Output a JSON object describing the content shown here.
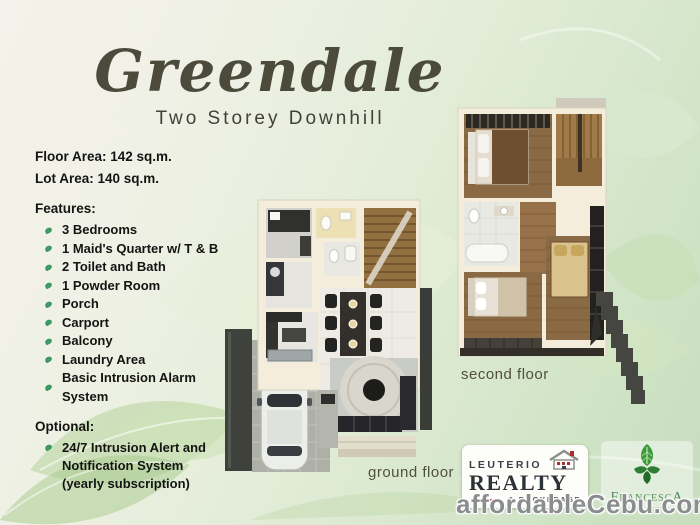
{
  "header": {
    "title": "Greendale",
    "subtitle": "Two Storey Downhill"
  },
  "specs": {
    "floor_area": "Floor Area: 142 sq.m.",
    "lot_area": "Lot Area: 140 sq.m."
  },
  "features": {
    "heading": "Features:",
    "items": [
      "3 Bedrooms",
      "1 Maid's Quarter w/ T & B",
      "2 Toilet and Bath",
      "1 Powder Room",
      "Porch",
      "Carport",
      "Balcony",
      "Laundry Area",
      "Basic Intrusion Alarm System"
    ]
  },
  "optional": {
    "heading": "Optional:",
    "lines": [
      "24/7 Intrusion Alert and",
      "Notification System",
      "(yearly subscription)"
    ]
  },
  "plans": {
    "ground_label": "ground floor",
    "second_label": "second floor"
  },
  "brands": {
    "leuterio": {
      "name_top": "LEUTERIO",
      "name_main": "REALTY",
      "name_sub": "& BROKERAGE"
    },
    "francesca": {
      "name": "FrancescA"
    }
  },
  "watermark": "affordableCebu.com",
  "colors": {
    "accent_green": "#3f9b63",
    "title_olive": "#4c4b3b",
    "floor_label_gray": "#50503f",
    "watermark_gray": "#8b8d8f",
    "leuterio_red": "#a83028",
    "francesca_green": "#3c9a3c"
  }
}
